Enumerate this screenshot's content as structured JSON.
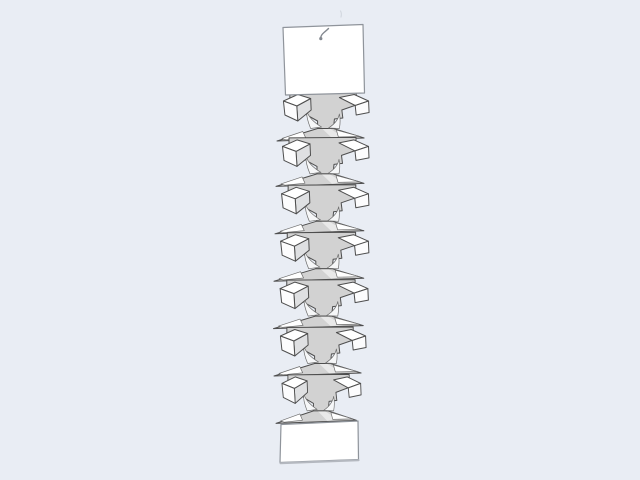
{
  "scene": {
    "description": "3D render of a vertical accordion-folded paper column hanging from a small hook, between two flat white panels",
    "background_color": "#e9edf4",
    "module_count": 7,
    "colors": {
      "outline": "#4e4e4e",
      "panel_stroke": "#8f949b",
      "face_main": "#d2d2d2",
      "face_side": "#dfe0e2",
      "face_white": "#ffffff",
      "face_front": "#fcfcfd",
      "highlight": "#f6f7f8",
      "shadow_edge": "#b4b8bf",
      "hook": "#83888f",
      "faint_mark": "#d3d8e0"
    },
    "modules": [
      {
        "x": 277,
        "y": 94,
        "sx": 0.99
      },
      {
        "x": 276,
        "y": 139.4,
        "sx": 1.0
      },
      {
        "x": 275,
        "y": 186.8,
        "sx": 1.01
      },
      {
        "x": 274,
        "y": 234.2,
        "sx": 1.02
      },
      {
        "x": 273.5,
        "y": 281.6,
        "sx": 1.02
      },
      {
        "x": 274,
        "y": 329,
        "sx": 0.99
      },
      {
        "x": 276,
        "y": 376.4,
        "sx": 0.915
      }
    ],
    "paths": {
      "top_panel": "M283,27.5 L363,24.5 L364.5,93 L285.5,95 Z",
      "bottom_panel": "M281,424.5 L358,421 L358.5,459.5 L280,462.5 Z",
      "bottom_shadow": "M280.5,463.2 L358.6,460.2",
      "hook_curl": "M328.5,28.5 Q327,30 324,32.5 Q320.5,35.5 320.8,38.2",
      "faint_mark": "M340.5,11 q1.5,2.5 0.5,6",
      "module": {
        "anvil": "M13,-1.5 L80,-2 L80,11 L65.5,16 L66.5,24 L58,25 L57,34.5 L41,34.5 L41,27 L30,21 L30,12 L13,8 Z",
        "skirt": "M41,34.5 L57,34.5 L88,44 L0,47 Z",
        "left_highlight": "M30,17 Q33,26 45,33 L34,34.5 Q29.5,24 30,17 Z",
        "right_highlight": "M63,20 Q61.5,28 52,34 L63,34.5 Q64.5,26.5 63,20 Z",
        "skirt_band": "M46,35 L54,35 L68,43.5 L56,44.5 Z",
        "left_sliver": "M5,44.5 L26,37.5 L29,43.8 L9,45.8 Z",
        "right_sliver": "M60,36 L84,42.5 L62,43 Z",
        "left_wing_side": "M20,12 L34,4.5 L34.5,16 L21,27 Z",
        "left_wing_top": "M6.5,7 L21,0.5 L34,4.5 L20,12 Z",
        "left_wing_front": "M6.5,7 L20,12 L21,27 L8,21 Z",
        "right_wing_top": "M63,3.5 L78,0.5 L92.5,7 L79,11.5 Z",
        "right_wing_front": "M79,11.5 L92.5,7 L93,18.5 L80,21 Z"
      }
    }
  }
}
